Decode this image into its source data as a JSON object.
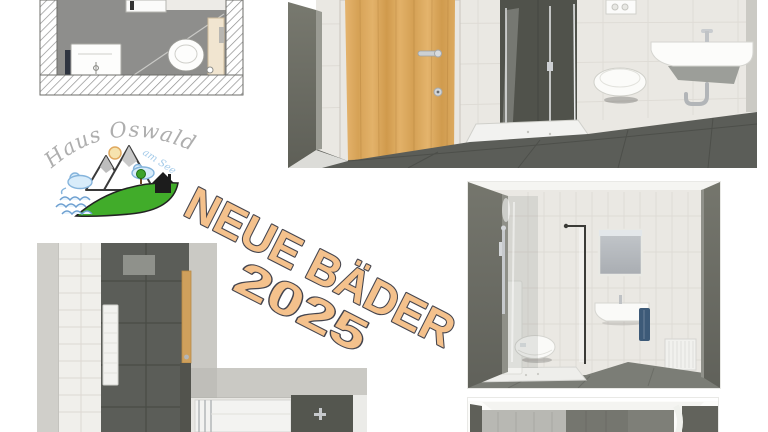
{
  "poster": {
    "background": "#ffffff",
    "headline": {
      "line1": "NEUE BÄDER",
      "line2": "2025",
      "rotation_deg": 27
    },
    "logo": {
      "title": "Haus Oswald",
      "subtitle": "am See"
    }
  },
  "theme": {
    "headline-fill": "#f4c18c",
    "headline-outline": "#45454e",
    "logo-text": "#aeaeae",
    "logo-subtext": "#a5cbe9",
    "hill-green": "#41ac2a",
    "wood": "#d8a65b",
    "tile-light": "#eae8e3",
    "wall-dark": "#6b6c63",
    "floor-dark": "#5b5d58",
    "fixture-white": "#f6f6f4",
    "chrome": "#b9bcbf",
    "plan-floor": "#8e8e8c",
    "towel-blue": "#3d5a78"
  }
}
